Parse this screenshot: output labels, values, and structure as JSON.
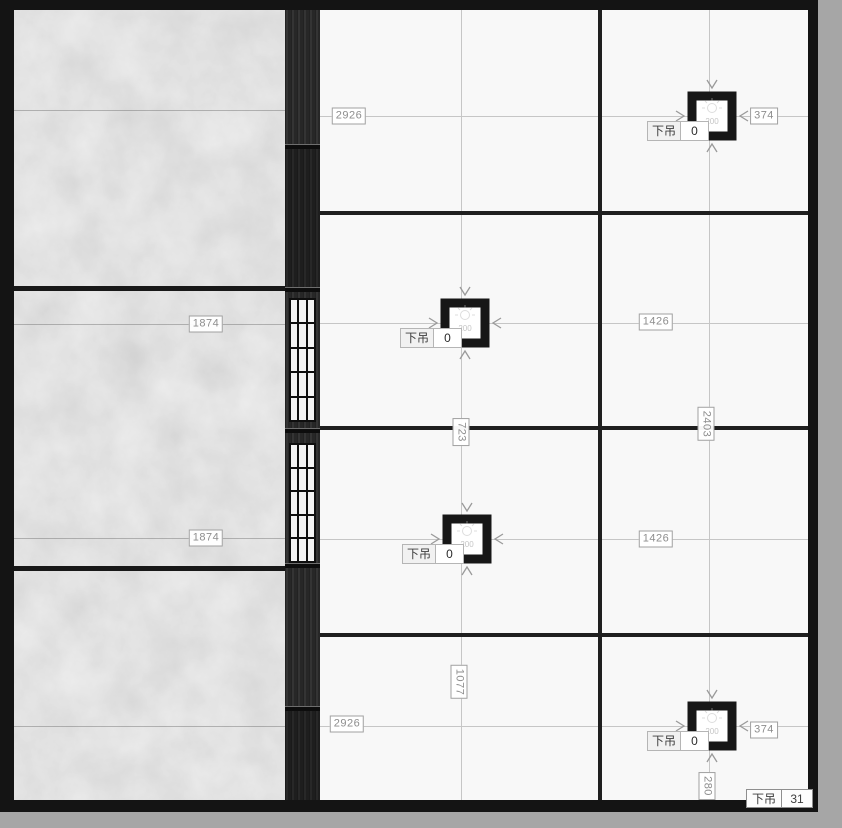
{
  "canvas": {
    "description_label": "ceiling-plan",
    "background_color": "#a6a6a6",
    "frame_color": "#141414",
    "panel_white": "#f8f8f8",
    "concrete_gray": "#c3c3c3",
    "strip_dark": "#2a2a2a"
  },
  "dims": {
    "top_width": "2926",
    "top_right_offset": "374",
    "left_upper": "1874",
    "left_lower": "1874",
    "right_mid_upper": "1426",
    "right_col_height": "2403",
    "mid_gap": "723",
    "right_mid_lower": "1426",
    "left_col_lower_height": "1077",
    "bottom_width": "2926",
    "bottom_right_offset": "374",
    "bottom_right_height": "280"
  },
  "fixture_tag_label": "下吊",
  "fixture_inner_text": "200",
  "fixtures": [
    {
      "value": "0"
    },
    {
      "value": "0"
    },
    {
      "value": "0"
    },
    {
      "value": "0"
    }
  ],
  "corner_badge": {
    "label": "下吊",
    "value": "31"
  }
}
